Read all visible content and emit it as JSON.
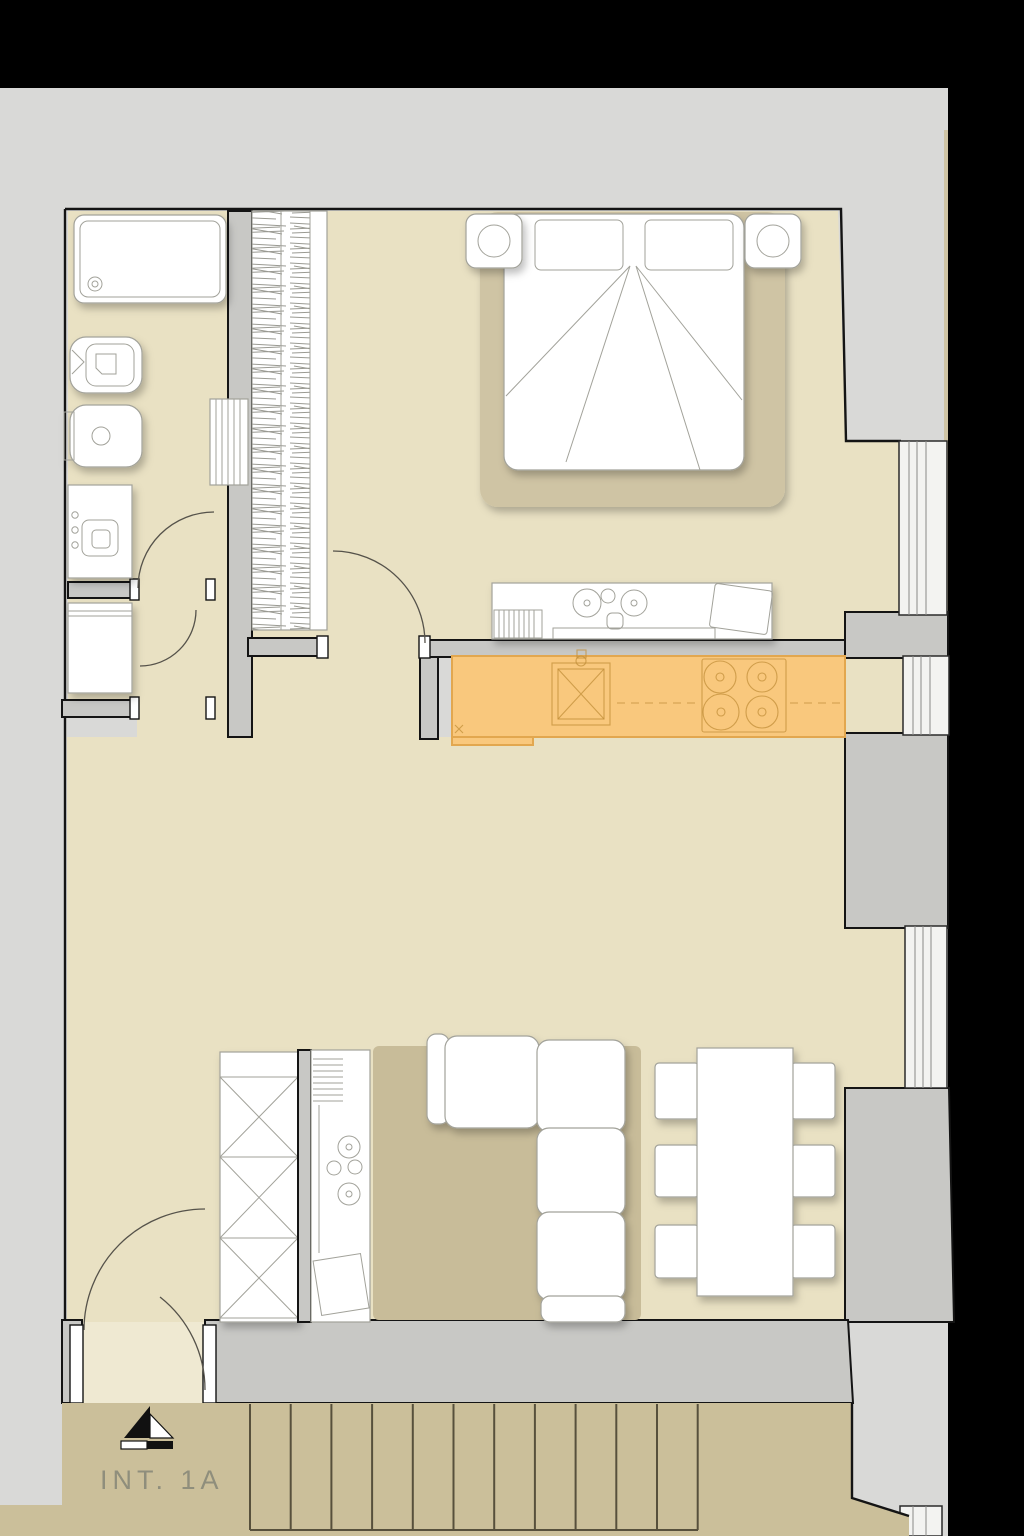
{
  "labels": {
    "unit": "INT. 1A"
  },
  "colors": {
    "black": "#000000",
    "gray": "#d9d9d7",
    "wallgray": "#c8c8c5",
    "ink": "#141414",
    "beige": "#e9e1c3",
    "beige_light": "#efe9d2",
    "beige_dim": "#cfc4a4",
    "tan": "#cbbf9a",
    "rug": "#c8bc99",
    "bedrug": "#cfc4a4",
    "accent": "#f9c87d",
    "accent_border": "#e2a74f",
    "accent_detail": "#c28f3a",
    "furnline": "#a2a29a",
    "stairline": "#57503c",
    "label_color": "#8f8e7c"
  },
  "stairs": {
    "tread_count": 12,
    "start_x": 250,
    "spacing": 40.7,
    "top_y": 1404,
    "bottom_y": 1530
  },
  "plan": {
    "unit_label": "INT. 1A",
    "highlight": "kitchen counter with sink and 4-burner hob (orange)",
    "rooms": [
      {
        "name": "bathroom",
        "furniture": [
          "bathtub",
          "toilet",
          "bidet",
          "vanity sink",
          "towel radiator"
        ]
      },
      {
        "name": "laundry",
        "furniture": [
          "washing machine"
        ]
      },
      {
        "name": "wardrobe-closet",
        "furniture": [
          "hanging rail (hatched)"
        ]
      },
      {
        "name": "bedroom",
        "furniture": [
          "double bed",
          "nightstand with lamp x2",
          "desk with chair"
        ]
      },
      {
        "name": "kitchen",
        "furniture": [
          "counter (highlighted)",
          "sink",
          "hob 4 burners"
        ]
      },
      {
        "name": "living-dining",
        "furniture": [
          "tall cabinets x3",
          "kitchenette counter with hob",
          "area rug",
          "corner sofa",
          "dining table",
          "chairs x6"
        ]
      },
      {
        "name": "entry",
        "furniture": [
          "entrance door"
        ]
      },
      {
        "name": "stairwell",
        "furniture": [
          "staircase",
          "landing",
          "entrance marker"
        ]
      }
    ],
    "windows": 4,
    "doors": 5
  }
}
